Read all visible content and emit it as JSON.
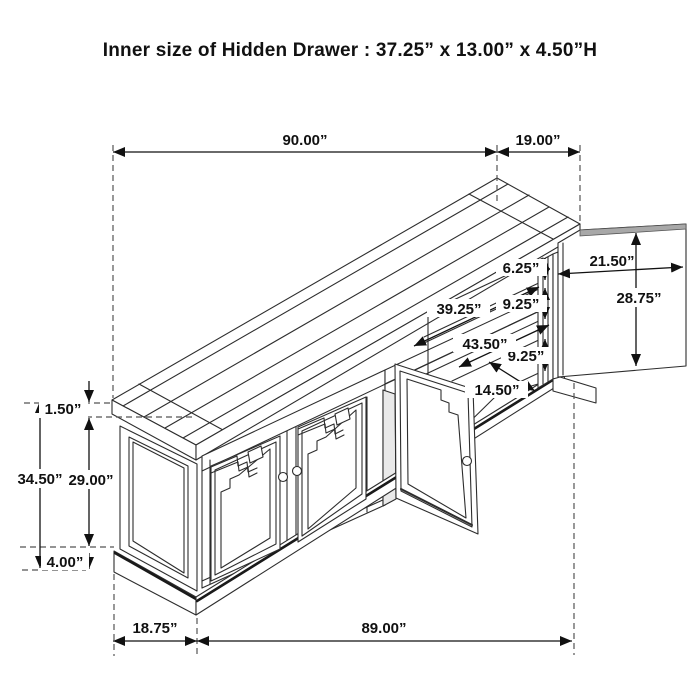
{
  "title": "Inner size of Hidden Drawer : 37.25” x 13.00” x 4.50”H",
  "dims": {
    "top_width": "90.00”",
    "top_depth": "19.00”",
    "side_door_width": "21.50”",
    "side_door_height": "28.75”",
    "top_opening_height": "6.25”",
    "middle_opening_height": "9.25”",
    "bottom_opening_height": "9.25”",
    "interior_width_front": "39.25”",
    "interior_width_back": "43.50”",
    "interior_depth": "14.50”",
    "top_thickness": "1.50”",
    "side_height": "34.50”",
    "door_opening_height": "29.00”",
    "base_height": "4.00”",
    "body_depth": "18.75”",
    "body_width": "89.00”"
  }
}
